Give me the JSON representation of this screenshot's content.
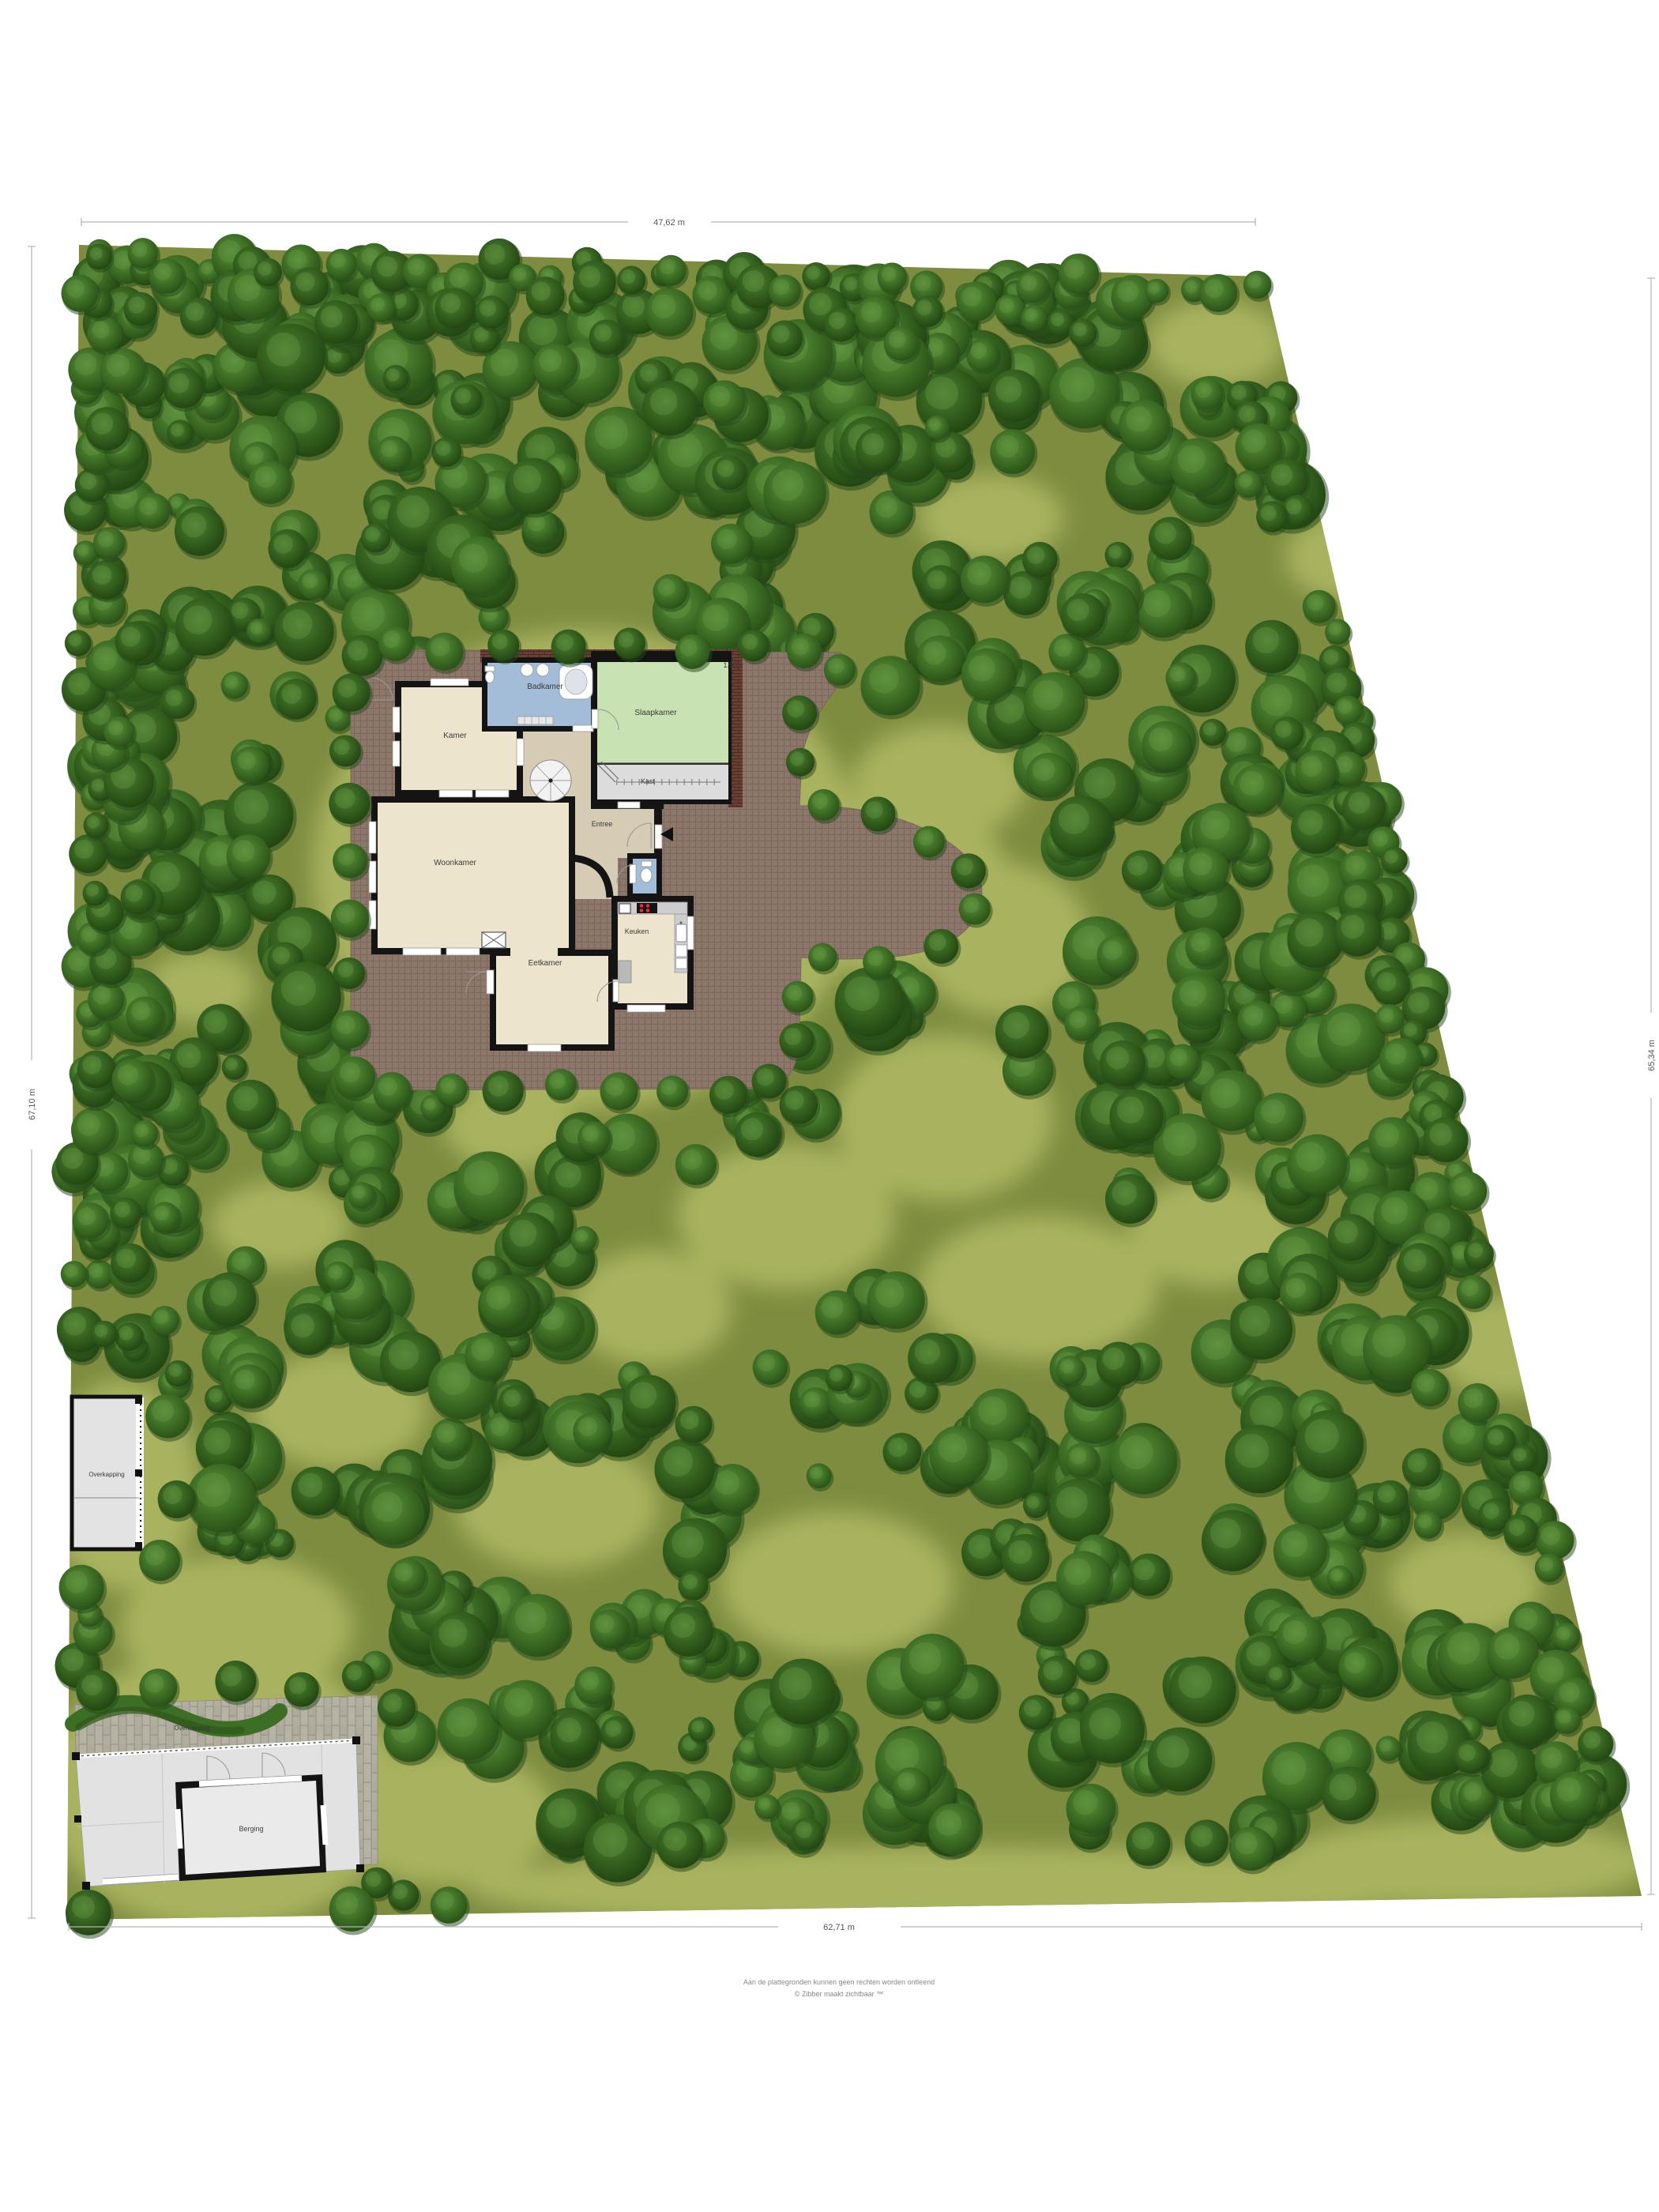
{
  "palette": {
    "grass": "#8e9c4c",
    "grass_light": "#a9b35f",
    "tree_dark": "#2b5318",
    "tree_mid": "#3f7026",
    "terrace": "#8d766a",
    "roof_brick": "#6b4034",
    "wall": "#141414",
    "room_beige": "#ece4cd",
    "hall_tan": "#d6ccb6",
    "bath_blue": "#a3bcd8",
    "bedroom_green": "#c9e2b3",
    "closet_gray": "#dcdcdc",
    "outbuilding_gray": "#e3e3e3"
  },
  "site": {
    "dimensions": {
      "top": "47,62 m",
      "bottom": "62,71 m",
      "left": "67,10 m",
      "right": "65,34 m"
    },
    "overhang_note": "1.50m"
  },
  "house": {
    "rooms": {
      "badkamer": "Badkamer",
      "slaapkamer": "Slaapkamer",
      "kast": "Kast",
      "kamer": "Kamer",
      "woonkamer": "Woonkamer",
      "entree": "Entree",
      "eetkamer": "Eetkamer",
      "keuken": "Keuken"
    }
  },
  "outbuildings": {
    "overkapping": "Overkapping",
    "driveway_overkapping": "Overkapping",
    "berging": "Berging"
  },
  "footer": {
    "line1": "Aan de plattegronden kunnen geen rechten worden ontleend",
    "line2": "© Zibber maakt zichtbaar ™"
  }
}
